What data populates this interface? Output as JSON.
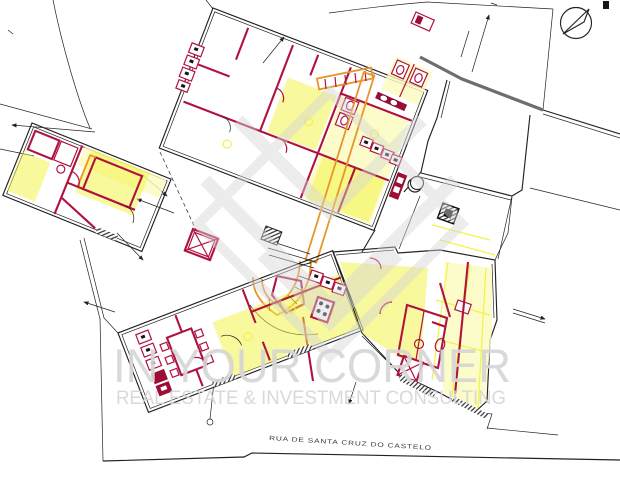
{
  "document": {
    "kind": "architectural floor plan / site plan",
    "street_label": "RUA DE SANTA CRUZ DO CASTELO"
  },
  "watermark": {
    "title": "IN YOUR CORNER",
    "subtitle": "REAL ESTATE & INVESTMENT CONSULTING"
  },
  "icons": {
    "north_arrow": "compass-north-arrow"
  },
  "colors": {
    "background": "#ffffff",
    "outline_black": "#222222",
    "outline_gray": "#6e6e6e",
    "wall_red": "#b01240",
    "wall_red_dark": "#9c0e36",
    "accent_orange": "#e8952e",
    "highlight_yellow": "#f2f23c",
    "highlight_pale": "#fbfbbd",
    "stair_fill": "#faf0b4",
    "watermark_gray": "#d6d6d6",
    "text_dark": "#3a3a3a"
  }
}
